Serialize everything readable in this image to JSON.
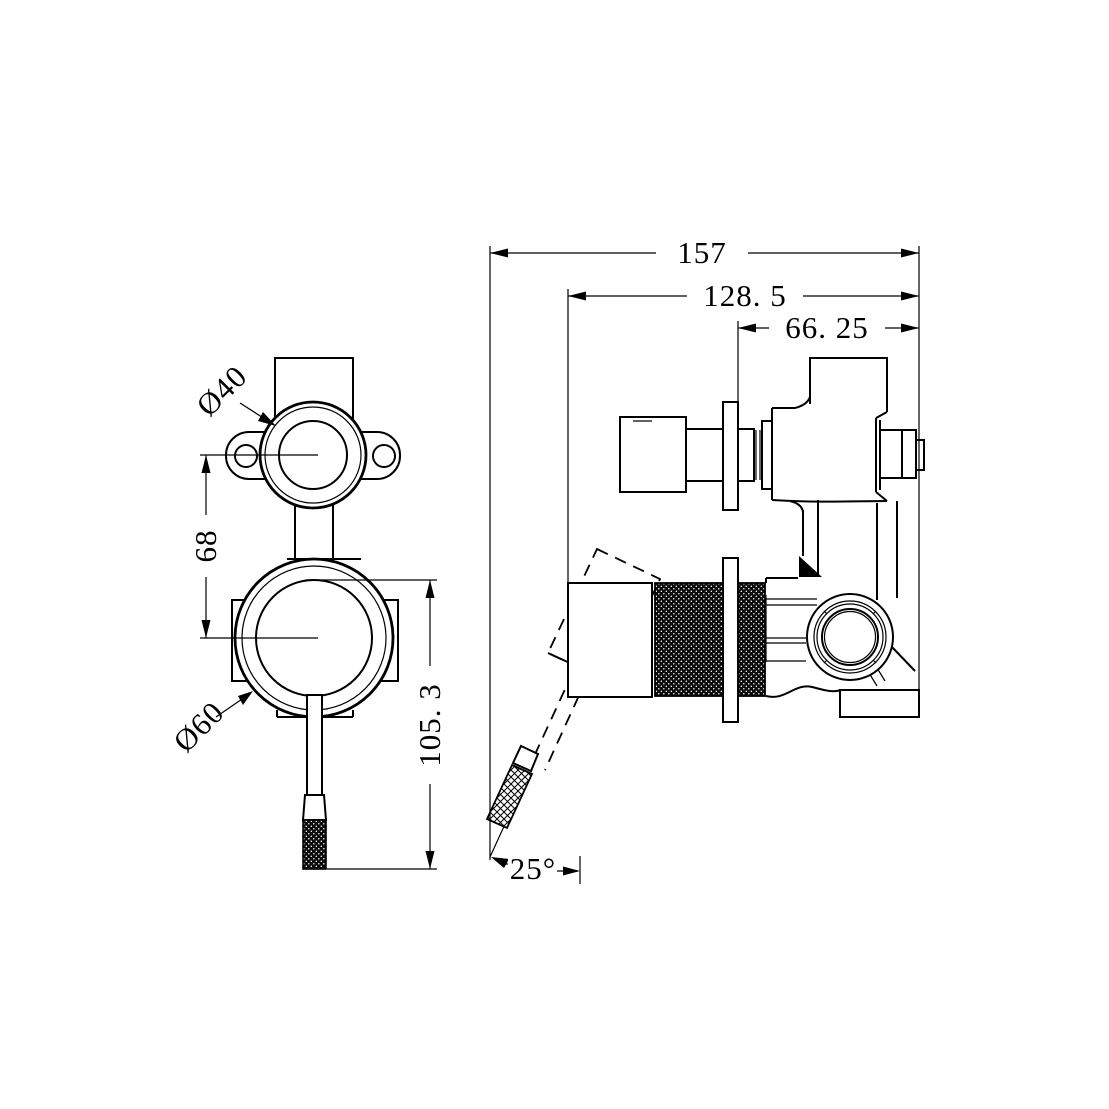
{
  "drawing": {
    "type": "technical-orthographic-drawing",
    "subject": "wall-mounted mixer valve with diverter and knurled lever",
    "colors": {
      "line": "#000000",
      "background": "#ffffff"
    },
    "dimensions": {
      "overall_depth": "157",
      "recess_depth": "128. 5",
      "wall_offset": "66. 25",
      "port_centres": "68",
      "trim_height": "105. 3",
      "lever_angle": "25°",
      "upper_trim_diameter": "Ø40",
      "lower_trim_diameter": "Ø60"
    }
  }
}
